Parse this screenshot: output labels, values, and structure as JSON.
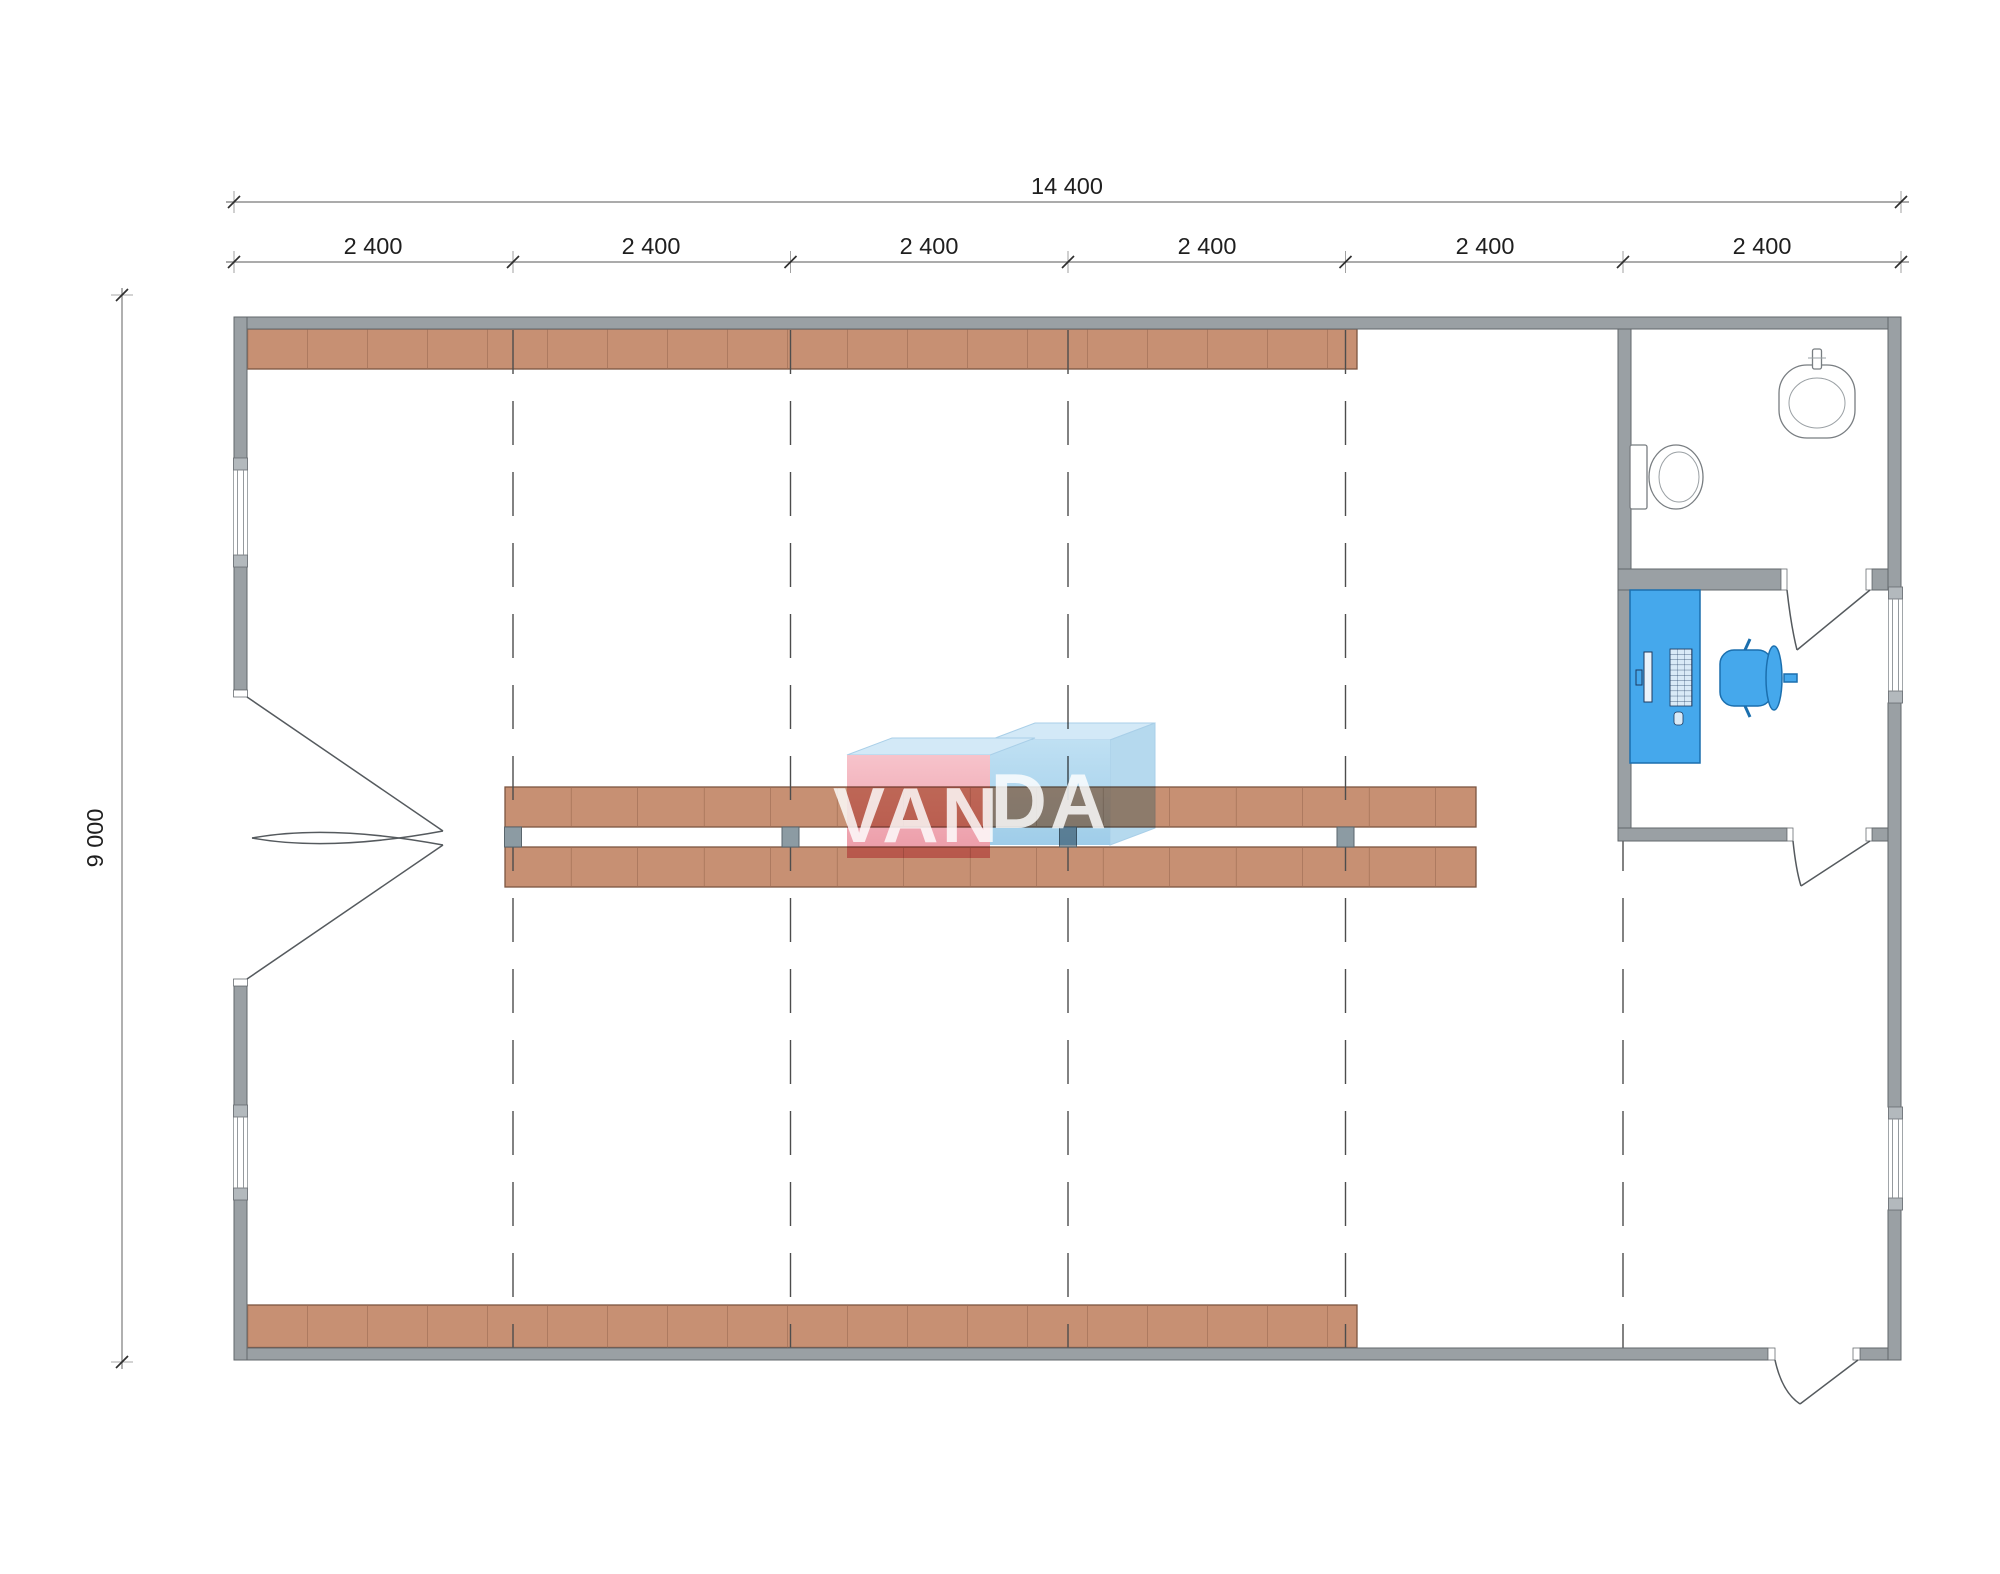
{
  "drawing": {
    "title": "warehouse-floor-plan",
    "dimensions": {
      "total_width_label": "14 400",
      "bay_labels": [
        "2 400",
        "2 400",
        "2 400",
        "2 400",
        "2 400",
        "2 400"
      ],
      "height_label": "9 000"
    },
    "watermark": {
      "text_left": "VAN",
      "text_right": "DA"
    },
    "colors": {
      "wall": "#9aa0a4",
      "wall_stroke": "#62676b",
      "shelf": "#c79073",
      "shelf_stroke": "#7d5642",
      "shelf_divider": "#9c6b52",
      "shelf_post": "#8c9ba3",
      "furniture_blue": "#45a8ec",
      "furniture_stroke": "#1b6fae",
      "dimension_text": "#1f1f1f",
      "dimension_line": "#8f8f8f",
      "grid_line": "#4d4d4d",
      "watermark_pink": "#f3b0ba",
      "watermark_blue": "#aed4ec",
      "watermark_top": "#d3e9f7",
      "watermark_text": "#ffffff"
    }
  }
}
